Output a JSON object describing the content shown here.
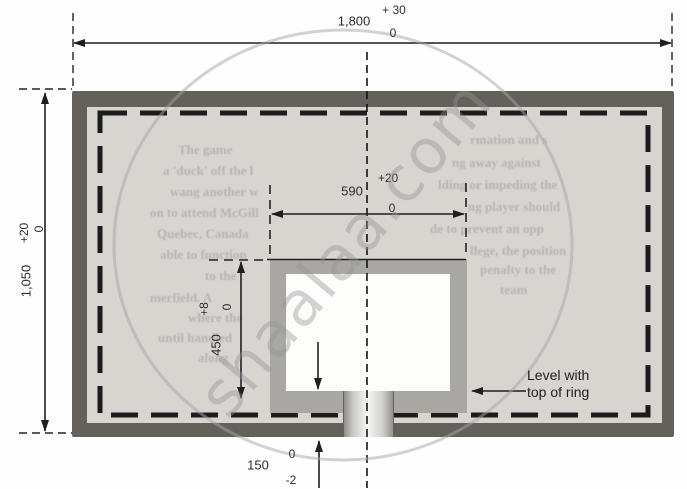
{
  "watermark": {
    "text": "shaalaa.com"
  },
  "dim_width": {
    "value": "1,800",
    "tol_top": "+ 30",
    "tol_bottom": "0"
  },
  "dim_height": {
    "value": "1,050",
    "tol_top": "+20",
    "tol_bottom": "0"
  },
  "dim_inner_width": {
    "value": "590",
    "tol_top": "+20",
    "tol_bottom": "0"
  },
  "dim_inner_height": {
    "value": "450",
    "tol_top": "+8",
    "tol_bottom": "0"
  },
  "dim_bottom": {
    "value": "150",
    "tol_top": "0",
    "tol_bottom": "-2"
  },
  "labels": {
    "ring_level_line1": "Level with",
    "ring_level_line2": "top of ring"
  },
  "colors": {
    "frame": "#63615a",
    "face": "#d7d5d0",
    "inner_border": "#a8a7a2",
    "marking_line": "#1c1c1c",
    "window": "#fdfdfc",
    "watermark": "#949496"
  },
  "show_through": {
    "left": [
      "The game",
      "a 'duck' off the l",
      "wang another w",
      "on to attend McGill",
      "Quebec, Canada",
      "able to function",
      "to the",
      "merfield. A",
      "where the",
      "until handled",
      "along"
    ],
    "right": [
      "rmation and s",
      "ng away against",
      "lding or impeding the",
      "ng player should",
      "de to prevent an opp",
      "llege, the position",
      "penalty to the",
      "team"
    ]
  }
}
